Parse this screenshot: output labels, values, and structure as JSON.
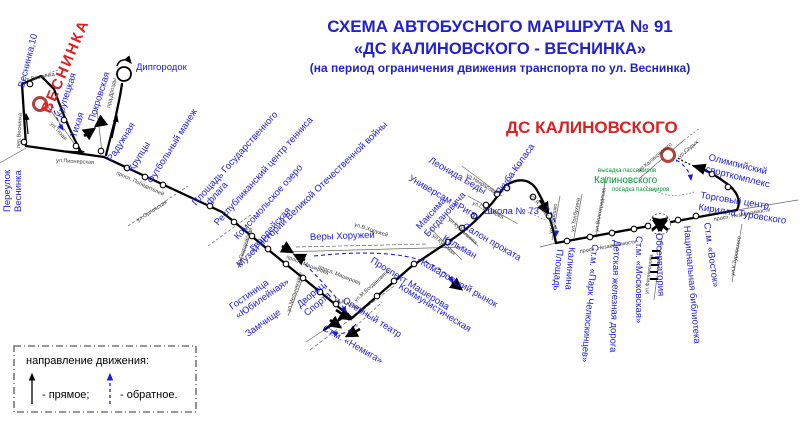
{
  "title": {
    "line1": "СХЕМА АВТОБУСНОГО МАРШРУТА № 91",
    "line2": "«ДС КАЛИНОВСКОГО - ВЕСНИНКА»",
    "line3": "(на период ограничения движения транспорта по ул. Веснинка)"
  },
  "terminals": {
    "vesninka": "ВЕСНИНКА",
    "kalinovskogo": "ДС КАЛИНОВСКОГО"
  },
  "green": {
    "drop": "высадка пассажиров",
    "stop_name": "Калиновского",
    "board": "посадка пассажиров"
  },
  "stops": {
    "vesninka10": "Веснинка,10",
    "per_vesninka_1": "Переулок",
    "per_vesninka_2": "Веснинка",
    "krupetskaya": "Крупецкая",
    "tihaya": "Тихая",
    "pokrovskaya": "Покровская",
    "dipgorodok": "Дипгородок",
    "raduzhnaya": "Радужная",
    "kruptsy": "Крупцы",
    "futbolny": "Футбольный манеж",
    "flag_1": "Площадь Государственного",
    "flag_2": "флага",
    "tennis": "Республиканский центр тенниса",
    "komsomolskoe": "Комсомольское озеро",
    "gvardeyskaya": "Гвардейская",
    "muzey": "Музей истории Великой Отечественной войны",
    "yubileynaya_1": "Гостиница",
    "yubileynaya_2": "«Юбилейная»",
    "dvorets_1": "Дворец",
    "dvorets_2": "Спорта",
    "zamchishche": "Замчище",
    "nemiga": "Ст.м. «Немига»",
    "operny": "Оперный театр",
    "kommunisticheskaya": "Коммунистическая",
    "prospekt_masherova": "Проспект Машерова",
    "very_horuzhey": "Веры Хоружей",
    "bogdanovicha_1": "Максима",
    "bogdanovicha_2": "Богдановича",
    "kulman": "Кульман",
    "komarovsky": "Комаровский рынок",
    "riga": "Универсам «Рига»",
    "beda": "Леонида Беды",
    "kolas": "Якуба Коласа",
    "salon": "Салон проката",
    "shkola": "Школа № 73",
    "kalinina_1": "Площадь",
    "kalinina_2": "Калинина",
    "chelyuskintsev": "Ст.м. «Парк Челюскинцев»",
    "detskaya": "Детская железная дорога",
    "moskovskaya": "Ст.м. «Московская»",
    "observatoriya": "Обсерватория",
    "vostok": "Ст.м. «Восток»",
    "biblioteka": "Национальная библиотека",
    "torgovy_1": "Торговый центр",
    "torgovy_2": "Кирилла Туровского",
    "olimpiysky_1": "Олимпийский",
    "olimpiysky_2": "спорткомплекс"
  },
  "streets": {
    "per_vesninka": "пер.Веснинка",
    "ul_vesninka": "ул.Веснинка",
    "tihaya": "ул.Тихая",
    "pionerskaya": "ул.Пионерская",
    "drozdy": "прд.Дрозды",
    "pobediteley": "просп. Победителей",
    "orlovskaya": "ул.Орловская",
    "gvardeyskaya": "ул.Гвардейская",
    "melnikayte": "ул.Мельникайте",
    "masherova1": "просп. Машерова",
    "masherova2": "просп. Машерова",
    "horuzhey": "ул.В.Хоружей",
    "bogdanovicha": "ул.М.Богдановича",
    "kupaly": "ул.Я.Купалы",
    "kuybysheva": "ул.Куйбышева",
    "kulman": "ул.Кульман",
    "nekrasova": "ул.Некрасова",
    "surganova": "ул.Сурганова",
    "kolasa": "ул.Я.Коласа",
    "kedyshko": "ул.Кедышко",
    "tolbuhina": "ул.Толбухина",
    "volgogradskaya": "ул.Волгоградская",
    "nezavisimosti1": "просп. Независимости",
    "nezavisimosti2": "просп. Независимости",
    "filimonova": "ул.Филимонова",
    "turovskogo": "ул.К.Туровского",
    "kalinovskogo": "ул.Калиновского",
    "sedyh": "ул.Седых"
  },
  "legend": {
    "heading": "направление движения:",
    "forward": "- прямое;",
    "reverse": "- обратное."
  },
  "colors": {
    "label_blue": "#1c1ce0",
    "title_blue": "#2222cc",
    "terminal_red": "#e02020",
    "terminal_ring": "#b5413a",
    "green_text": "#009933",
    "route_black": "#000000"
  }
}
